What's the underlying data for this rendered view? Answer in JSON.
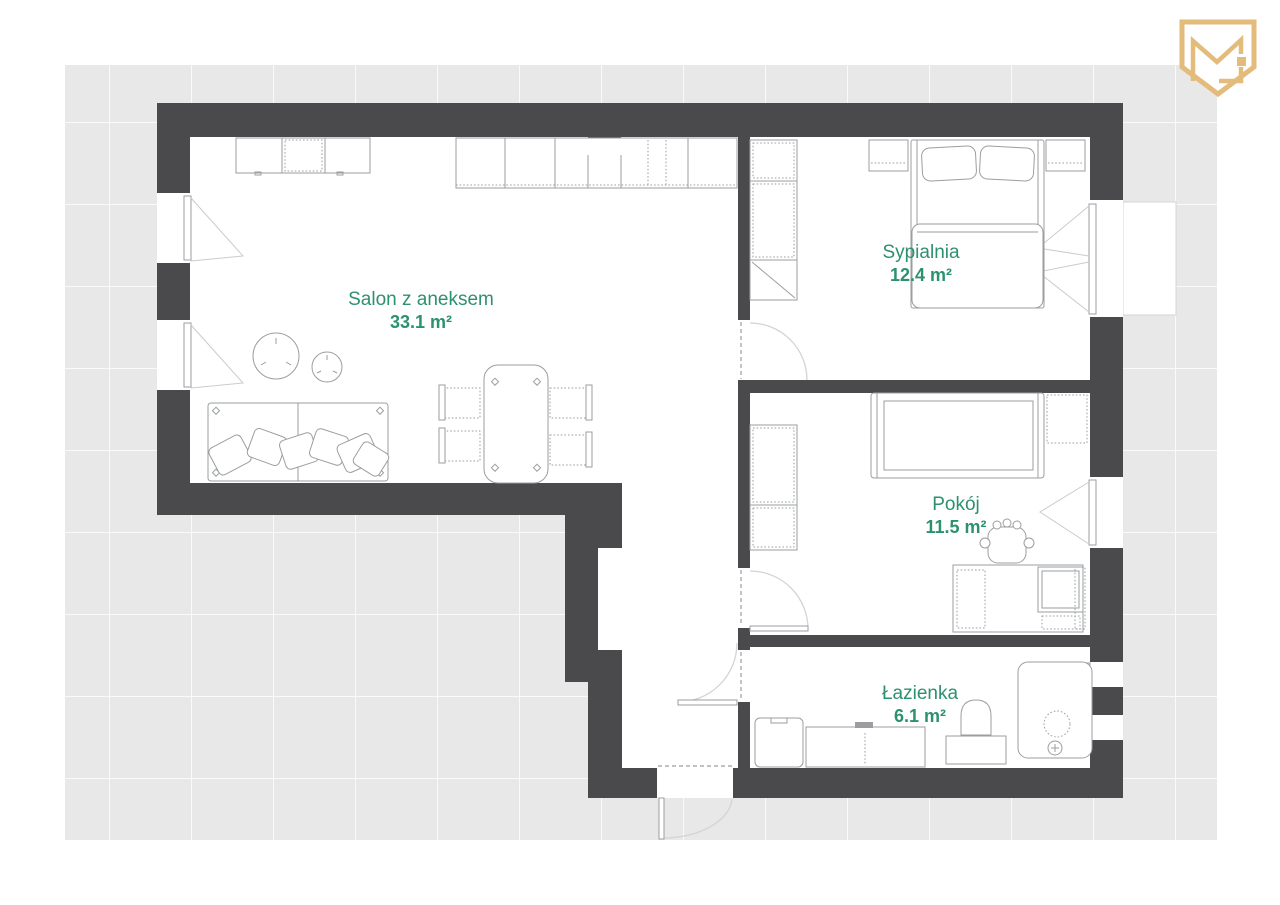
{
  "rooms": [
    {
      "id": "salon",
      "name": "Salon z aneksem",
      "area": "33.1 m²"
    },
    {
      "id": "sypialnia",
      "name": "Sypialnia",
      "area": "12.4 m²"
    },
    {
      "id": "pokoj",
      "name": "Pokój",
      "area": "11.5 m²"
    },
    {
      "id": "lazienka",
      "name": "Łazienka",
      "area": "6.1 m²"
    }
  ],
  "logo": {
    "icon": "monogram-shield-logo",
    "monogram": "MH"
  },
  "colors": {
    "wall": "#4a4a4c",
    "room_label": "#2d9170",
    "logo_gold": "#e3bb7b",
    "backdrop": "#e8e8e9",
    "furniture_line": "#9b9ea0"
  }
}
